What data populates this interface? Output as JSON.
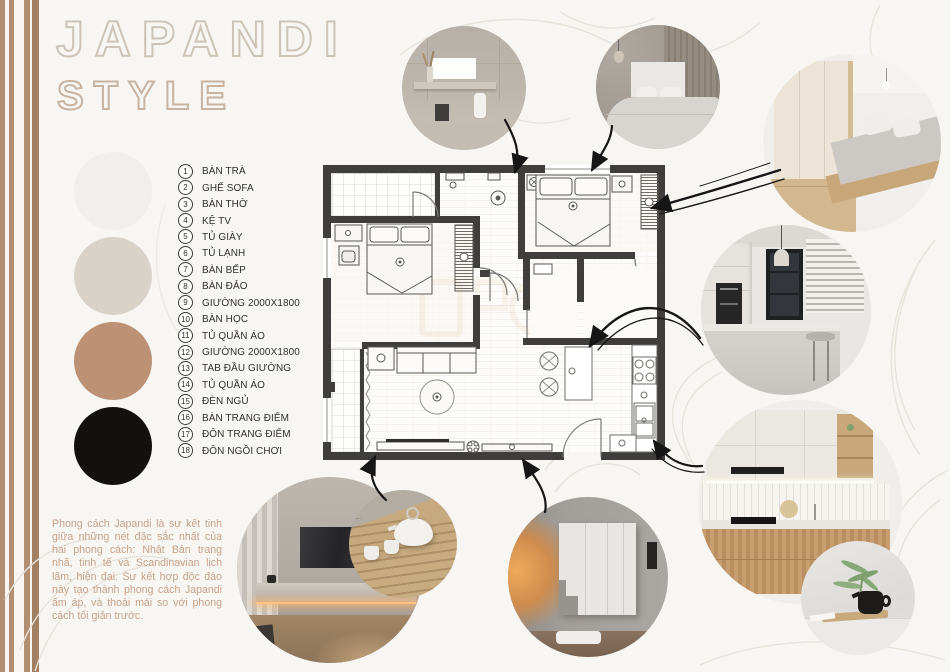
{
  "title": {
    "line1": "JAPANDI",
    "line2": "STYLE"
  },
  "legend": {
    "items": [
      {
        "num": "1",
        "label": "BÀN TRÀ"
      },
      {
        "num": "2",
        "label": "GHẾ SOFA"
      },
      {
        "num": "3",
        "label": "BÀN THỜ"
      },
      {
        "num": "4",
        "label": "KỆ TV"
      },
      {
        "num": "5",
        "label": "TỦ GIÀY"
      },
      {
        "num": "6",
        "label": "TỦ LẠNH"
      },
      {
        "num": "7",
        "label": "BÀN BẾP"
      },
      {
        "num": "8",
        "label": "BÀN ĐẢO"
      },
      {
        "num": "9",
        "label": "GIƯỜNG 2000X1800"
      },
      {
        "num": "10",
        "label": "BÀN HỌC"
      },
      {
        "num": "11",
        "label": "TỦ QUẦN ÁO"
      },
      {
        "num": "12",
        "label": "GIƯỜNG 2000X1800"
      },
      {
        "num": "13",
        "label": "TAB ĐẦU GIƯỜNG"
      },
      {
        "num": "14",
        "label": "TỦ QUẦN ÁO"
      },
      {
        "num": "15",
        "label": "ĐÈN NGỦ"
      },
      {
        "num": "16",
        "label": "BÀN TRANG ĐIỂM"
      },
      {
        "num": "17",
        "label": "ĐÔN TRANG ĐIỂM"
      },
      {
        "num": "18",
        "label": "ĐÔN NGỒI CHƠI"
      }
    ]
  },
  "palette": {
    "swatches": [
      {
        "name": "off-white",
        "hex": "#f0efec"
      },
      {
        "name": "greige",
        "hex": "#d9d2c8"
      },
      {
        "name": "tan",
        "hex": "#bc9174"
      },
      {
        "name": "black",
        "hex": "#121110"
      }
    ]
  },
  "description": {
    "text": "Phong cách Japandi là sự kết tinh giữa những nét đặc sắc nhất của hai phong cách: Nhật Bản trang nhã, tinh tế và Scandinavian lịch lãm, hiện đại. Sự kết hợp độc đáo này tạo thành phong cách Japandi ấm áp, và thoải mái so với phong cách tối giản trước."
  },
  "accents": {
    "stripe_color": "#b48e71",
    "stripe_color_dark": "#a37f62",
    "wall_color": "#3f3e3c",
    "arrow_color": "#161616"
  }
}
